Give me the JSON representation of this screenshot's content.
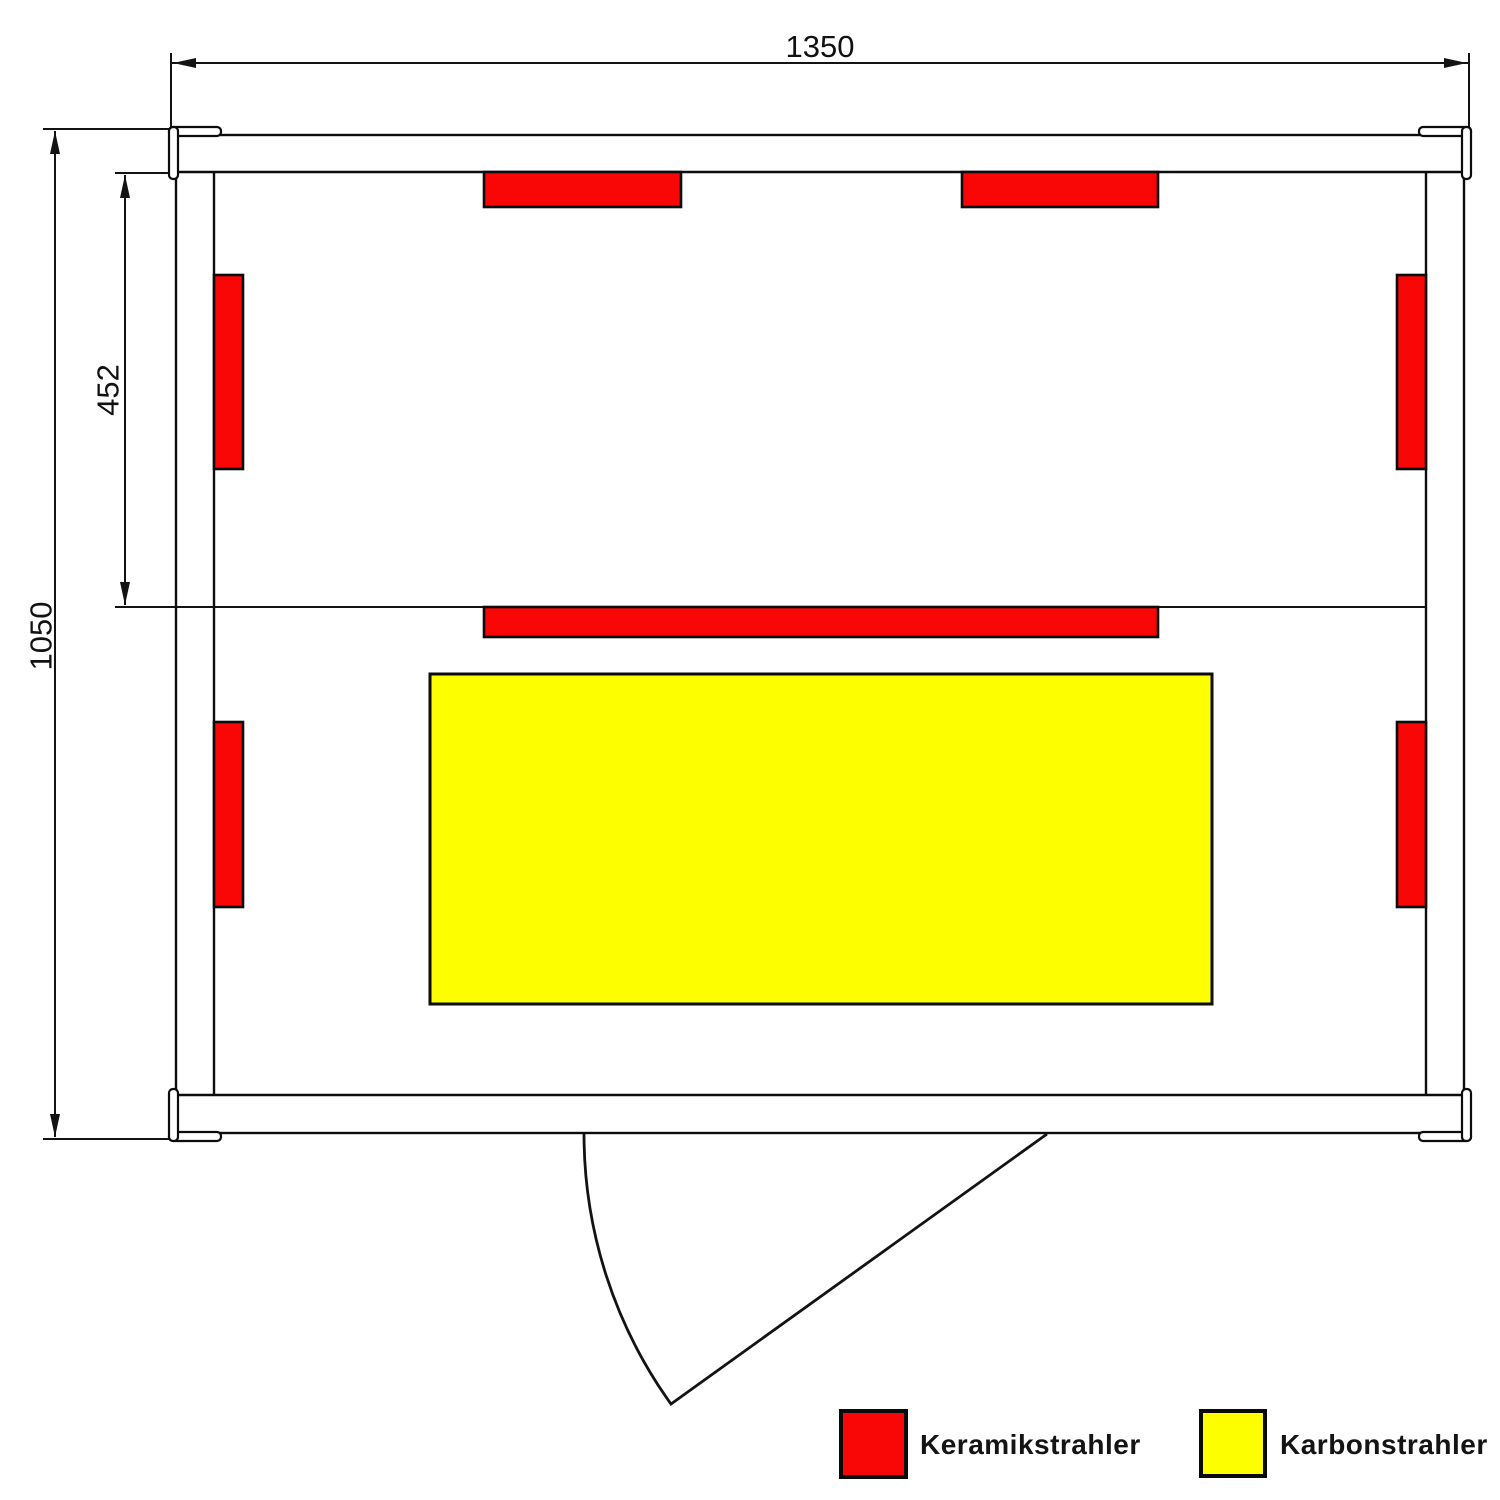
{
  "diagram": {
    "type": "sauna-floor-plan",
    "dimensions": {
      "overall_width": "1350",
      "overall_depth": "1050",
      "rear_zone_depth": "452"
    },
    "colors": {
      "ceramic_red": "#F90606",
      "carbon_yellow": "#FDFF00",
      "line_black": "#0c0c0c",
      "background": "#ffffff"
    },
    "legend": {
      "items": [
        {
          "label": "Keramikstrahler",
          "color": "#F90606"
        },
        {
          "label": "Karbonstrahler",
          "color": "#FDFF00"
        }
      ]
    }
  }
}
